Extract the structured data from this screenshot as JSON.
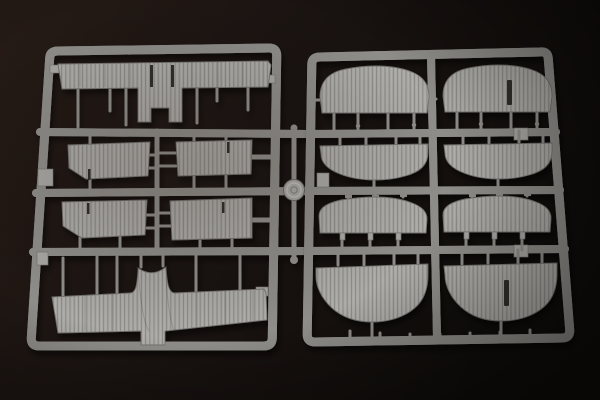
{
  "colors": {
    "background_left": "#261b16",
    "background_mid": "#181210",
    "background_right": "#100d0b",
    "plastic": "#a9a7a3",
    "plastic_highlight": "#d2d0cc",
    "plastic_mid": "#8f8d89",
    "plastic_dark": "#6b6966",
    "part_edge": "#73716d",
    "slot": "#332f2b"
  },
  "scene": {
    "label": "photograph of two gray plastic model-kit sprues on dark background",
    "left_sprue": {
      "label": "left sprue with wing parts",
      "parts": [
        "upper wing panel with center tab and slots",
        "ribbed wing panel top-left",
        "ribbed wing panel top-right",
        "ribbed wing panel bottom-left",
        "ribbed wing panel bottom-right",
        "lower wing with center fairing"
      ]
    },
    "right_sprue": {
      "label": "right sprue with eight rounded panels",
      "parts": [
        "rounded panel row1 left",
        "rounded panel row1 right with slot",
        "rounded panel row2 left",
        "rounded panel row2 right",
        "rounded panel row3 left",
        "rounded panel row3 right",
        "rounded panel row4 left",
        "rounded panel row4 right with slot"
      ]
    },
    "medallion": "circular brand medallion on center runner"
  }
}
